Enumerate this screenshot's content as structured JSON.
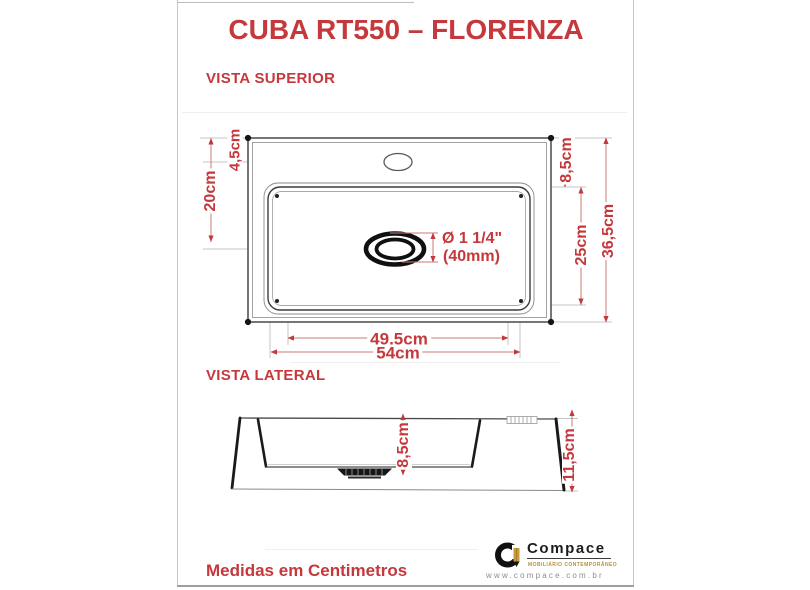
{
  "title": "CUBA RT550 – FLORENZA",
  "sections": {
    "top_view_label": "VISTA SUPERIOR",
    "side_view_label": "VISTA LATERAL"
  },
  "footer_note": "Medidas em Centimetros",
  "top_view": {
    "dim_top_to_faucet": "4,5cm",
    "dim_faucet_to_drain": "20cm",
    "dim_top_to_basin": "8,5cm",
    "dim_basin_depth_front": "25cm",
    "dim_total_depth": "36,5cm",
    "dim_basin_width": "49,5cm",
    "dim_total_width": "54cm",
    "drain_diameter_inches": "Ø 1 1/4\"",
    "drain_diameter_mm": "(40mm)"
  },
  "side_view": {
    "dim_basin_height": "8,5cm",
    "dim_total_height": "11,5cm"
  },
  "brand": {
    "name": "Compace",
    "tagline": "MOBILIÁRIO CONTEMPORÂNEO",
    "website": "www.compace.com.br"
  },
  "colors": {
    "accent_red": "#c5383c",
    "brand_gold": "#b5923b"
  }
}
